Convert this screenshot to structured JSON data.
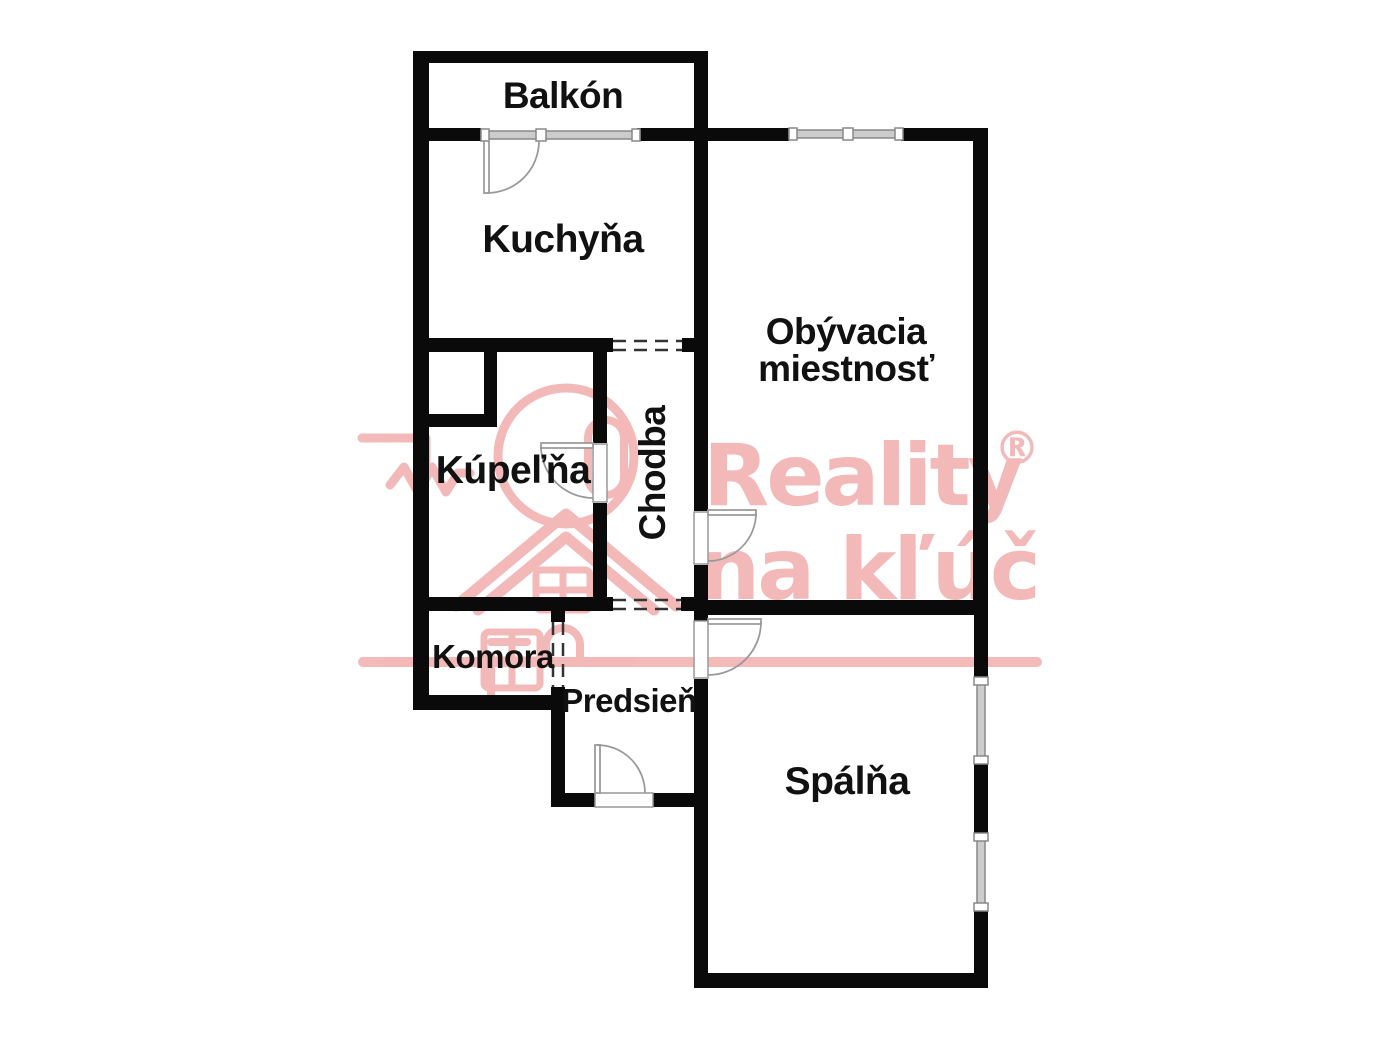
{
  "rooms": {
    "balkon": {
      "label": "Balkón"
    },
    "kuchyna": {
      "label": "Kuchyňa"
    },
    "obyvacia": {
      "label_line1": "Obývacia",
      "label_line2": "miestnosť"
    },
    "chodba": {
      "label": "Chodba"
    },
    "kupelna": {
      "label": "Kúpeľňa"
    },
    "komora": {
      "label": "Komora"
    },
    "predsien": {
      "label": "Predsieň"
    },
    "spalna": {
      "label": "Spálňa"
    }
  },
  "watermark": {
    "brand": "Reality",
    "registered": "®",
    "tagline": "na kľúč",
    "color": "#f2b4b4"
  },
  "colors": {
    "background": "#ffffff",
    "walls": "#0a0a0a",
    "door_lines": "#999999",
    "window_fill": "#cccccc",
    "dashed_openings": "#333333"
  }
}
